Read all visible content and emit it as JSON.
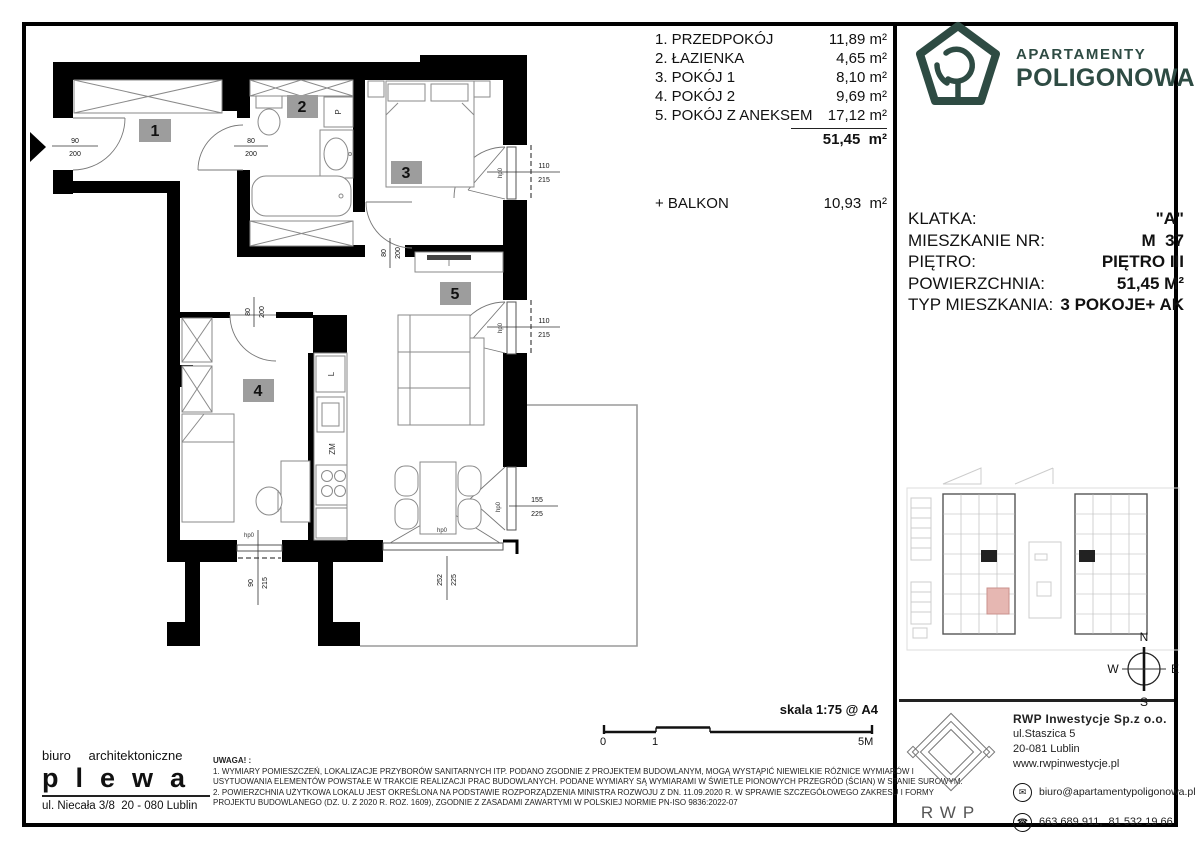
{
  "room_list": {
    "rows": [
      {
        "label": "1. PRZEDPOKÓJ",
        "area": "11,89 m²"
      },
      {
        "label": "2. ŁAZIENKA",
        "area": "4,65 m²"
      },
      {
        "label": "3. POKÓJ 1",
        "area": "8,10 m²"
      },
      {
        "label": "4. POKÓJ 2",
        "area": "9,69 m²"
      },
      {
        "label": "5. POKÓJ Z ANEKSEM",
        "area": "17,12 m²"
      }
    ],
    "total": "51,45  m²",
    "balcony_label": "+ BALKON",
    "balcony_area": "10,93  m²"
  },
  "plan": {
    "room_numbers": [
      "1",
      "2",
      "3",
      "4",
      "5"
    ],
    "entry_door": {
      "w": "90",
      "h": "200"
    },
    "bath_door": {
      "w": "80",
      "h": "200"
    },
    "room3_door": {
      "w": "80",
      "h": "200"
    },
    "room4_door": {
      "w": "80",
      "h": "200"
    },
    "balcony_door1": {
      "w": "110",
      "h": "215"
    },
    "balcony_door2": {
      "w": "110",
      "h": "215"
    },
    "window_right": {
      "w": "155",
      "h": "225"
    },
    "window_bottom": {
      "w": "90",
      "h": "215"
    },
    "window_front": {
      "w": "252",
      "h": "225"
    },
    "sill_label": "hp0",
    "washer_label": "P",
    "fridge_label": "L",
    "dishwasher_label": "ZM"
  },
  "brand": {
    "name_top": "APARTAMENTY",
    "name_bottom": "POLIGONOWA",
    "color": "#2e4b43"
  },
  "info": {
    "rows": [
      {
        "label": "KLATKA:",
        "value": "\"A\""
      },
      {
        "label": "MIESZKANIE NR:",
        "value": "M  37"
      },
      {
        "label": "PIĘTRO:",
        "value": "PIĘTRO III"
      },
      {
        "label": "POWIERZCHNIA:",
        "value": "51,45 M²"
      },
      {
        "label": "TYP MIESZKANIA:",
        "value": "3 POKOJE+ AK"
      }
    ]
  },
  "compass": {
    "n": "N",
    "e": "E",
    "s": "S",
    "w": "W"
  },
  "scale_bar": {
    "label": "skala 1:75 @ A4",
    "tick_0": "0",
    "tick_1": "1",
    "tick_end": "5M"
  },
  "architect": {
    "line1": "biuro architektoniczne",
    "name": "plewa",
    "address": "ul. Niecała 3/8  20 - 080 Lublin"
  },
  "notes": {
    "heading": "UWAGA! :",
    "line1": "1. WYMIARY POMIESZCZEŃ, LOKALIZACJE PRZYBORÓW SANITARNYCH ITP. PODANO ZGODNIE Z PROJEKTEM BUDOWLANYM, MOGĄ WYSTĄPIĆ NIEWIELKIE RÓŻNICE WYMIARÓW I",
    "line2": "USYTUOWANIA ELEMENTÓW POWSTAŁE W TRAKCIE REALIZACJI PRAC BUDOWLANYCH. PODANE WYMIARY SĄ WYMIARAMI W ŚWIETLE PIONOWYCH PRZEGRÓD (ŚCIAN) W STANIE SUROWYM.",
    "line3": "2. POWIERZCHNIA UŻYTKOWA LOKALU JEST OKREŚLONA NA PODSTAWIE ROZPORZĄDZENIA MINISTRA ROZWOJU Z DN. 11.09.2020 R. W SPRAWIE SZCZEGÓŁOWEGO ZAKRESU I FORMY",
    "line4": "PROJEKTU BUDOWLANEGO (DZ. U. Z 2020 R. ROZ. 1609), ZGODNIE Z ZASADAMI ZAWARTYMI W POLSKIEJ NORMIE PN-ISO 9836:2022-07"
  },
  "developer": {
    "logo_text": "RWP",
    "name": "RWP Inwestycje Sp.z o.o.",
    "address_line1": "ul.Staszica 5",
    "address_line2": "20-081 Lublin",
    "website": "www.rwpinwestycje.pl",
    "email": "biuro@apartamentypoligonowa.pl",
    "phones": "663 689 911,  81 532 19 66"
  }
}
